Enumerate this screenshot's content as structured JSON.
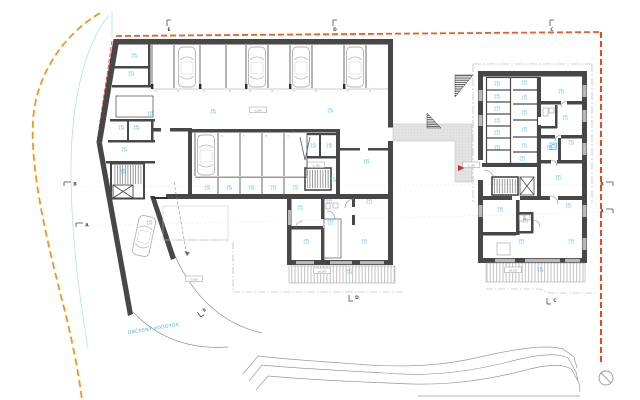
{
  "drawing": {
    "kind": "basement-floor-plan"
  },
  "colors": {
    "wall": "#474747",
    "boundary_orange": "#f7941d",
    "boundary_orange_red": "#ee4623",
    "red_line": "#ff2d23",
    "label_blue": "#3aa7e0",
    "hatch_gray": "#c2c2c2",
    "outline_gray": "#9b9b9b",
    "cyan_guide": "#b7e0dd"
  },
  "markers": [
    {
      "letter": "E",
      "x": 167,
      "y": 20,
      "type": "top"
    },
    {
      "letter": "D",
      "x": 333,
      "y": 20,
      "type": "top"
    },
    {
      "letter": "C",
      "x": 550,
      "y": 20,
      "type": "top"
    },
    {
      "letter": "B",
      "x": 64,
      "y": 182,
      "type": "left"
    },
    {
      "letter": "A",
      "x": 76,
      "y": 223,
      "type": "left"
    },
    {
      "letter": "B",
      "x": 613,
      "y": 182,
      "type": "right"
    },
    {
      "letter": "A",
      "x": 613,
      "y": 209,
      "type": "right"
    },
    {
      "letter": "E",
      "x": 201,
      "y": 317,
      "type": "rot",
      "rot": -38
    },
    {
      "letter": "D",
      "x": 349,
      "y": 301,
      "type": "bottom"
    },
    {
      "letter": "C",
      "x": 547,
      "y": 304,
      "type": "bottom"
    }
  ],
  "room_labels": [
    {
      "x": 134,
      "y": 55,
      "a": "1.02",
      "b": "-3,04"
    },
    {
      "x": 131,
      "y": 73,
      "a": "1.03",
      "b": "-3,04"
    },
    {
      "x": 150,
      "y": 113,
      "a": "1.04",
      "b": "-3,04"
    },
    {
      "x": 121,
      "y": 127,
      "a": "1.05",
      "b": "-3,04"
    },
    {
      "x": 136,
      "y": 127,
      "a": "1.06",
      "b": "-3,04"
    },
    {
      "x": 124,
      "y": 149,
      "a": "1.07",
      "b": "-3,04"
    },
    {
      "x": 123,
      "y": 171,
      "a": "1.08",
      "b": "-3,04"
    },
    {
      "x": 213,
      "y": 111,
      "a": "1.01",
      "b": "-3,04"
    },
    {
      "x": 330,
      "y": 110,
      "a": "1.01",
      "b": "-3,04"
    },
    {
      "x": 149,
      "y": 222,
      "a": "1.19",
      "b": "-2,10"
    },
    {
      "x": 207,
      "y": 187,
      "a": "1.10",
      "b": "-3,04"
    },
    {
      "x": 229,
      "y": 187,
      "a": "1.11",
      "b": "-3,04"
    },
    {
      "x": 251,
      "y": 187,
      "a": "1.12",
      "b": "-3,04"
    },
    {
      "x": 273,
      "y": 187,
      "a": "1.13",
      "b": "-3,04"
    },
    {
      "x": 295,
      "y": 187,
      "a": "1.14",
      "b": "-3,04"
    },
    {
      "x": 313,
      "y": 145,
      "a": "1.15",
      "b": "-3,04"
    },
    {
      "x": 329,
      "y": 145,
      "a": "1.16",
      "b": "-3,04"
    },
    {
      "x": 333,
      "y": 179,
      "a": "1.17",
      "b": "-3,04"
    },
    {
      "x": 366,
      "y": 161,
      "a": "1.18",
      "b": "-3,04"
    },
    {
      "x": 300,
      "y": 207,
      "a": "2.01",
      "b": "-1,10"
    },
    {
      "x": 329,
      "y": 201,
      "a": "2.02",
      "b": "-1,10"
    },
    {
      "x": 369,
      "y": 201,
      "a": "2.03",
      "b": "-1,10"
    },
    {
      "x": 330,
      "y": 222,
      "a": "2.04",
      "b": "-1,10"
    },
    {
      "x": 306,
      "y": 241,
      "a": "2.05",
      "b": "-1,10"
    },
    {
      "x": 364,
      "y": 241,
      "a": "2.06",
      "b": "-1,10"
    },
    {
      "x": 349,
      "y": 271,
      "a": "2.07",
      "b": "-1,08"
    },
    {
      "x": 497,
      "y": 83,
      "a": "1.21",
      "b": "-1,10"
    },
    {
      "x": 497,
      "y": 96,
      "a": "1.22",
      "b": "-1,10"
    },
    {
      "x": 497,
      "y": 108,
      "a": "1.23",
      "b": "-1,10"
    },
    {
      "x": 497,
      "y": 120,
      "a": "1.24",
      "b": "-1,10"
    },
    {
      "x": 497,
      "y": 132,
      "a": "1.25",
      "b": "-1,10"
    },
    {
      "x": 497,
      "y": 147,
      "a": "1.26",
      "b": "-1,10"
    },
    {
      "x": 524,
      "y": 82,
      "a": "1.27",
      "b": "-1,10"
    },
    {
      "x": 524,
      "y": 97,
      "a": "1.28",
      "b": "-1,10"
    },
    {
      "x": 524,
      "y": 112,
      "a": "1.29",
      "b": "-1,10"
    },
    {
      "x": 524,
      "y": 129,
      "a": "1.30",
      "b": "-1,10"
    },
    {
      "x": 524,
      "y": 145,
      "a": "1.31",
      "b": "-1,10"
    },
    {
      "x": 522,
      "y": 158,
      "a": "1.32",
      "b": "-1,10"
    },
    {
      "x": 561,
      "y": 91,
      "a": "3.01",
      "b": "-1,10"
    },
    {
      "x": 565,
      "y": 117,
      "a": "3.02",
      "b": "-1,10"
    },
    {
      "x": 571,
      "y": 142,
      "a": "3.03",
      "b": "-1,10"
    },
    {
      "x": 549,
      "y": 147,
      "a": "3.04",
      "b": "-1,10"
    },
    {
      "x": 558,
      "y": 177,
      "a": "3.05",
      "b": "-1,10"
    },
    {
      "x": 500,
      "y": 209,
      "a": "3.06",
      "b": "-1,10"
    },
    {
      "x": 525,
      "y": 220,
      "a": "3.07",
      "b": "-1,10"
    },
    {
      "x": 568,
      "y": 205,
      "a": "3.08",
      "b": "-1,10"
    },
    {
      "x": 521,
      "y": 241,
      "a": "3.09",
      "b": "-1,10"
    },
    {
      "x": 571,
      "y": 241,
      "a": "3.10",
      "b": "-1,10"
    },
    {
      "x": 540,
      "y": 269,
      "a": "3.11",
      "b": "-1,08"
    }
  ],
  "parking_labels": [
    {
      "x": 156,
      "y": 91.5,
      "t": "01"
    },
    {
      "x": 178,
      "y": 91.5,
      "t": "02"
    },
    {
      "x": 204,
      "y": 91.5,
      "t": "03"
    },
    {
      "x": 230,
      "y": 91.5,
      "t": "04"
    },
    {
      "x": 250,
      "y": 91.5,
      "t": "05"
    },
    {
      "x": 272,
      "y": 91.5,
      "t": "06"
    },
    {
      "x": 294,
      "y": 91.5,
      "t": "07"
    },
    {
      "x": 316,
      "y": 91.5,
      "t": "08"
    },
    {
      "x": 348,
      "y": 91.5,
      "t": "09"
    },
    {
      "x": 370,
      "y": 91.5,
      "t": "10"
    },
    {
      "x": 199,
      "y": 136.5,
      "t": "11"
    },
    {
      "x": 222,
      "y": 136.5,
      "t": "12"
    },
    {
      "x": 244,
      "y": 136.5,
      "t": "13"
    },
    {
      "x": 266,
      "y": 136.5,
      "t": "14"
    },
    {
      "x": 288,
      "y": 136.5,
      "t": "15"
    }
  ],
  "boxed_labels": [
    {
      "x": 258,
      "y": 111,
      "t": "-3,040"
    },
    {
      "x": 316,
      "y": 166,
      "t": "-1,100"
    },
    {
      "x": 194,
      "y": 280,
      "t": "-0,350"
    },
    {
      "x": 322,
      "y": 272,
      "t": "±0,000"
    },
    {
      "x": 513,
      "y": 271,
      "t": "±0,000"
    },
    {
      "x": 471,
      "y": 166,
      "t": "-1,100"
    }
  ],
  "cars": [
    {
      "x": 187,
      "y": 67,
      "r": 0
    },
    {
      "x": 257,
      "y": 67,
      "r": 0
    },
    {
      "x": 301,
      "y": 67,
      "r": 0
    },
    {
      "x": 355,
      "y": 67,
      "r": 0
    },
    {
      "x": 206,
      "y": 155,
      "r": 0
    },
    {
      "x": 144,
      "y": 236,
      "r": 12
    }
  ],
  "icons": [
    {
      "name": "washing-machine",
      "x": 550,
      "y": 143
    }
  ],
  "annotations": {
    "stream_text": "OBČASNÝ VODOTOK",
    "stream_x": 128,
    "stream_y": 334,
    "stream_rot": -9
  },
  "north_arrow": {
    "x": 606,
    "y": 378
  },
  "entrance": {
    "x": 458,
    "y": 168
  }
}
